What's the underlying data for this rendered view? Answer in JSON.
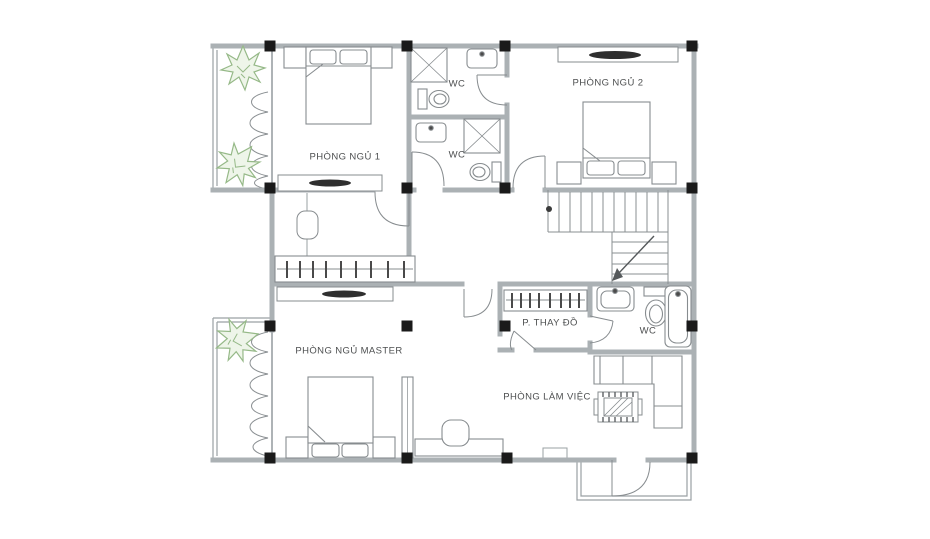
{
  "drawing": {
    "type": "floor-plan",
    "floor": "upper floor with 3 bedrooms, 3 WCs, dressing room and office"
  },
  "colors": {
    "background": "#ffffff",
    "wall": "#abb1b4",
    "thin_line": "#9aa0a3",
    "furniture_line": "#878c8f",
    "label_text": "#4d4f50",
    "column_black": "#1a1a1a",
    "dark_accent": "#2f2f2f",
    "plant_stroke": "#96b988",
    "plant_fill": "#eef5e9"
  },
  "rooms": [
    {
      "id": "phong-ngu-1",
      "label": "PHÒNG NGỦ 1"
    },
    {
      "id": "wc-top",
      "label": "WC"
    },
    {
      "id": "wc-mid",
      "label": "WC"
    },
    {
      "id": "phong-ngu-2",
      "label": "PHÒNG NGỦ 2"
    },
    {
      "id": "phong-ngu-master",
      "label": "PHÒNG NGỦ MASTER"
    },
    {
      "id": "p-thay-do",
      "label": "P. THAY ĐỒ"
    },
    {
      "id": "wc-right",
      "label": "WC"
    },
    {
      "id": "phong-lam-viec",
      "label": "PHÒNG LÀM VIỆC"
    }
  ],
  "icons": {
    "plant": "starburst-shrub",
    "stair_arrow": "down-direction-arrow",
    "column": "filled-black-square"
  }
}
